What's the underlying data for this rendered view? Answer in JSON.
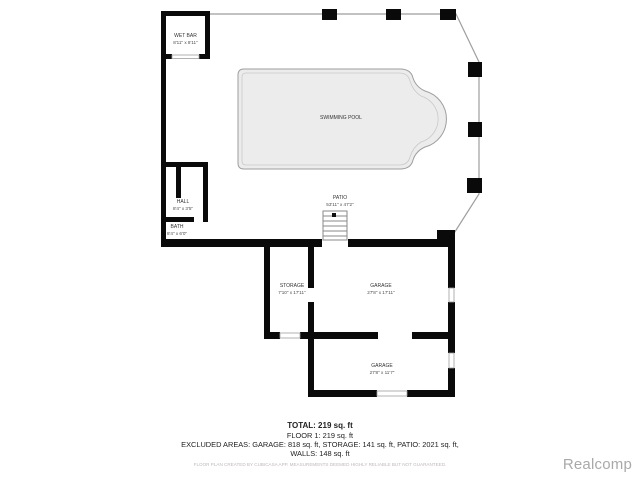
{
  "rooms": {
    "wet_bar": {
      "name": "WET BAR",
      "dims": "8'11\" x 8'11\""
    },
    "swimming_pool": {
      "name": "SWIMMING POOL"
    },
    "patio": {
      "name": "PATIO",
      "dims": "53'11\" x 47'2\""
    },
    "hall": {
      "name": "HALL",
      "dims": "8'4\" x 3'5\""
    },
    "bath": {
      "name": "BATH",
      "dims": "8'4\" x 6'0\""
    },
    "storage": {
      "name": "STORAGE",
      "dims": "7'10\" x 17'11\""
    },
    "garage_upper": {
      "name": "GARAGE",
      "dims": "27'8\" x 17'11\""
    },
    "garage_lower": {
      "name": "GARAGE",
      "dims": "27'8\" x 11'7\""
    }
  },
  "summary": {
    "total_label": "TOTAL: 219 sq. ft",
    "floor_label": "FLOOR 1: 219 sq. ft",
    "excluded_label": "EXCLUDED AREAS: GARAGE: 818 sq. ft, STORAGE: 141 sq. ft, PATIO: 2021 sq. ft,",
    "walls_label": "WALLS: 148 sq. ft",
    "disclaimer": "FLOOR PLAN CREATED BY CUBICASA APP. MEASUREMENTS DEEMED HIGHLY RELIABLE BUT NOT GUARANTEED."
  },
  "colors": {
    "wall": "#0a0a0a",
    "perimeter": "#9e9e9e",
    "pool_fill": "#ececec",
    "watermark_gray": "#a9a9a9"
  },
  "watermark": "Realcomp"
}
